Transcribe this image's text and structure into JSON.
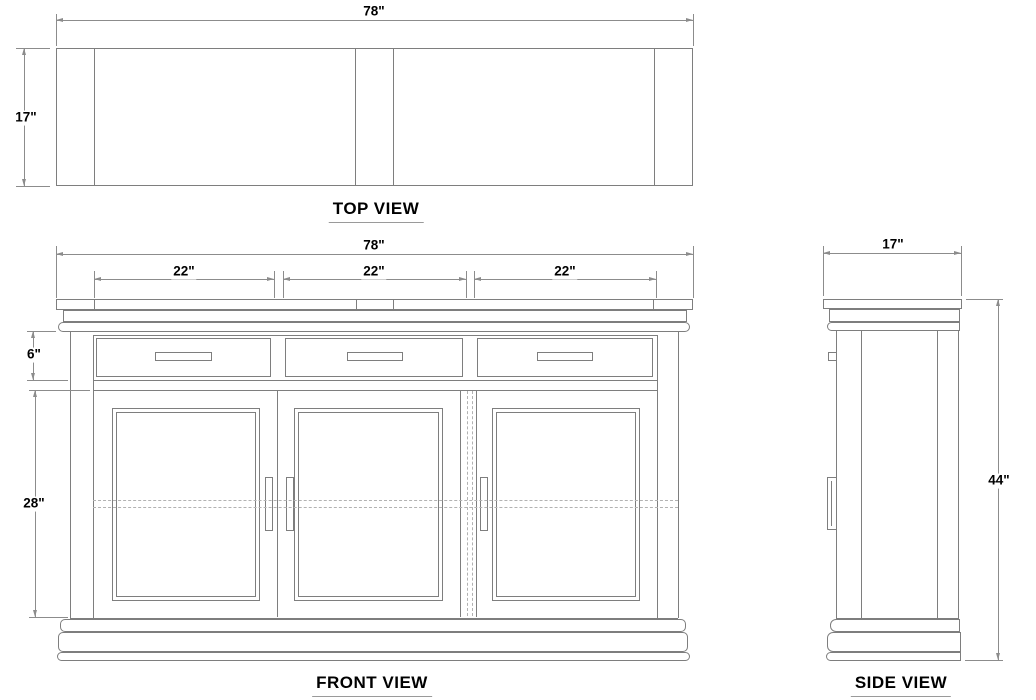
{
  "top_view": {
    "title": "TOP VIEW",
    "width_label": "78\"",
    "depth_label": "17\""
  },
  "front_view": {
    "title": "FRONT VIEW",
    "width_label": "78\"",
    "section_labels": [
      "22\"",
      "22\"",
      "22\""
    ],
    "drawer_height_label": "6\"",
    "door_height_label": "28\""
  },
  "side_view": {
    "title": "SIDE VIEW",
    "depth_label": "17\"",
    "height_label": "44\""
  },
  "colors": {
    "line": "#7e7e7e",
    "dimension": "#8c8c8c",
    "hidden_line": "#b2b2b2",
    "text": "#000000",
    "background": "#ffffff"
  }
}
